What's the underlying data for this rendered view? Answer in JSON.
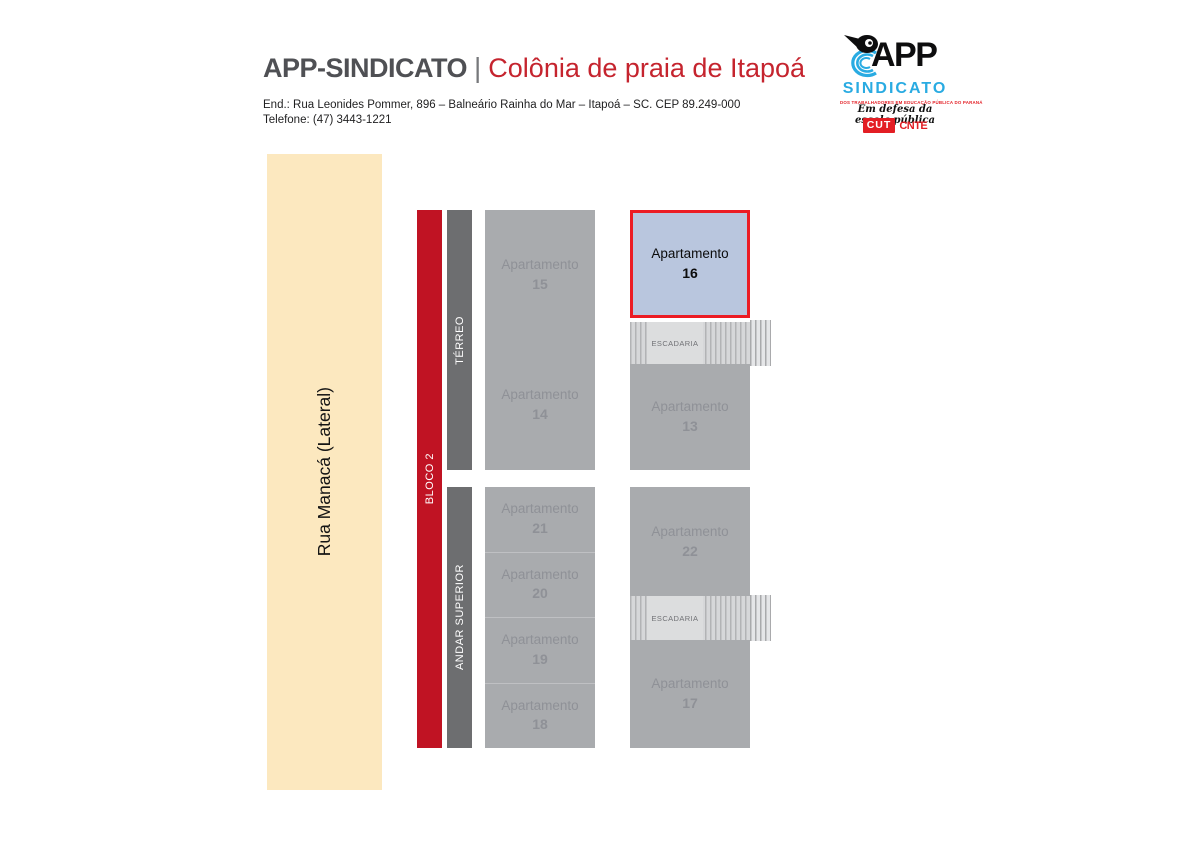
{
  "colors": {
    "beige": "#fce8bf",
    "red-bar": "#c01323",
    "dark-bar": "#6d6e70",
    "block-gray": "#a9abae",
    "block-text": "#8f9197",
    "divider": "#bfc0c3",
    "highlight-fill": "#b9c6de",
    "highlight-border": "#ec1c24",
    "esc-label-bg": "#dcddde",
    "esc-text": "#717276",
    "title-dark": "#4f5054",
    "title-red": "#c5242e",
    "logo-blue": "#29abe2",
    "logo-red": "#e31e24"
  },
  "header": {
    "title_main": "APP-SINDICATO",
    "title_separator": "|",
    "title_sub": "Colônia de praia de Itapoá",
    "address_line": "End.: Rua Leonides Pommer, 896 – Balneário Rainha do Mar – Itapoá – SC. CEP 89.249-000",
    "phone_line": "Telefone: (47) 3443-1221"
  },
  "logo": {
    "app_text": "APP",
    "sindicato_text": "SINDICATO",
    "small_line": "DOS TRABALHADORES EM EDUCAÇÃO PÚBLICA DO PARANÁ",
    "slogan": "Em defesa da escola pública",
    "cut_text": "CUT",
    "cnte_text": "CNTE"
  },
  "map": {
    "street_label": "Rua Manacá (Lateral)",
    "bloco_label": "BLOCO 2",
    "floor_terreo": "TÉRREO",
    "floor_superior": "ANDAR SUPERIOR",
    "escadaria": "ESCADARIA",
    "apartment_word": "Apartamento",
    "numbers": {
      "a15": "15",
      "a16": "16",
      "a14": "14",
      "a13": "13",
      "a21": "21",
      "a20": "20",
      "a19": "19",
      "a18": "18",
      "a22": "22",
      "a17": "17"
    }
  }
}
